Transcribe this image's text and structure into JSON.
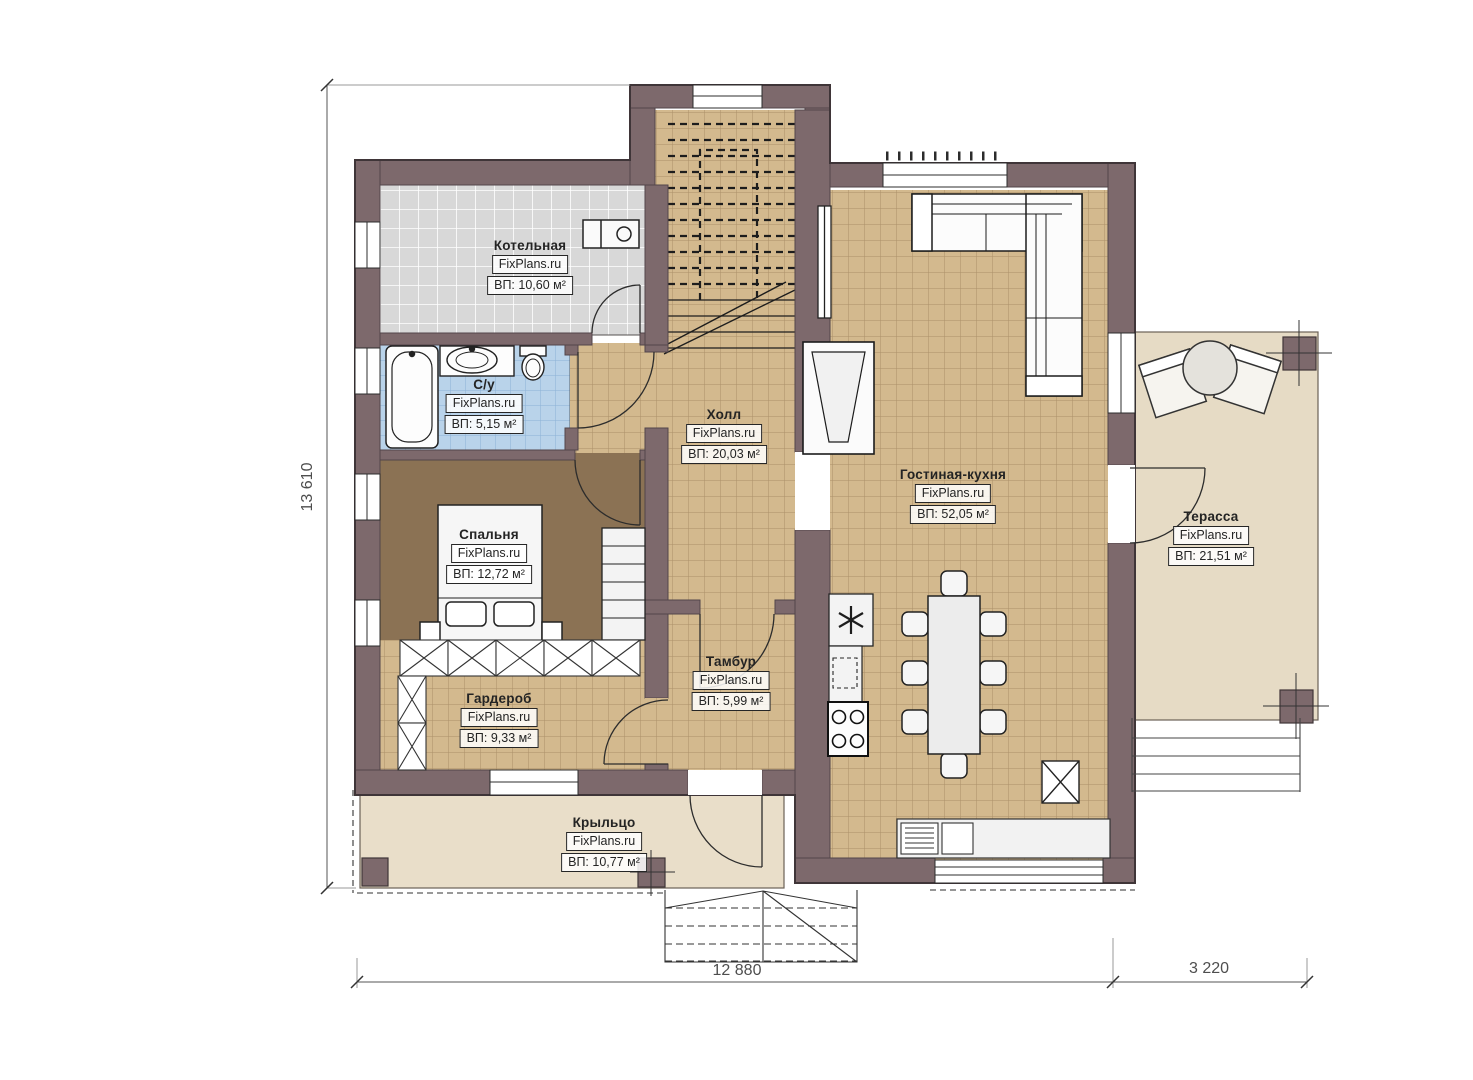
{
  "plan": {
    "brand": "FixPlans.ru",
    "rooms": [
      {
        "id": "boiler-room",
        "name": "Котельная",
        "brand": "FixPlans.ru",
        "area": "ВП: 10,60 м²"
      },
      {
        "id": "bathroom",
        "name": "С/у",
        "brand": "FixPlans.ru",
        "area": "ВП: 5,15 м²"
      },
      {
        "id": "hall",
        "name": "Холл",
        "brand": "FixPlans.ru",
        "area": "ВП: 20,03 м²"
      },
      {
        "id": "living-kitchen",
        "name": "Гостиная-кухня",
        "brand": "FixPlans.ru",
        "area": "ВП: 52,05 м²"
      },
      {
        "id": "bedroom",
        "name": "Спальня",
        "brand": "FixPlans.ru",
        "area": "ВП: 12,72 м²"
      },
      {
        "id": "vestibule",
        "name": "Тамбур",
        "brand": "FixPlans.ru",
        "area": "ВП: 5,99 м²"
      },
      {
        "id": "wardrobe",
        "name": "Гардероб",
        "brand": "FixPlans.ru",
        "area": "ВП: 9,33 м²"
      },
      {
        "id": "porch",
        "name": "Крыльцо",
        "brand": "FixPlans.ru",
        "area": "ВП: 10,77 м²"
      },
      {
        "id": "terrace",
        "name": "Терасса",
        "brand": "FixPlans.ru",
        "area": "ВП: 21,51 м²"
      }
    ],
    "dimensions": [
      {
        "id": "house-height",
        "value": "13 610"
      },
      {
        "id": "house-width",
        "value": "12 880"
      },
      {
        "id": "terrace-width",
        "value": "3 220"
      }
    ],
    "colors": {
      "wall": "#7d696c",
      "tile_tan": "#d3b98e",
      "tile_gray": "#d8d8d8",
      "tile_blue": "#b9d3ea",
      "bedroom_floor": "#8b7254",
      "outdoor_floor": "#e8ddc8",
      "background": "#ffffff"
    }
  }
}
